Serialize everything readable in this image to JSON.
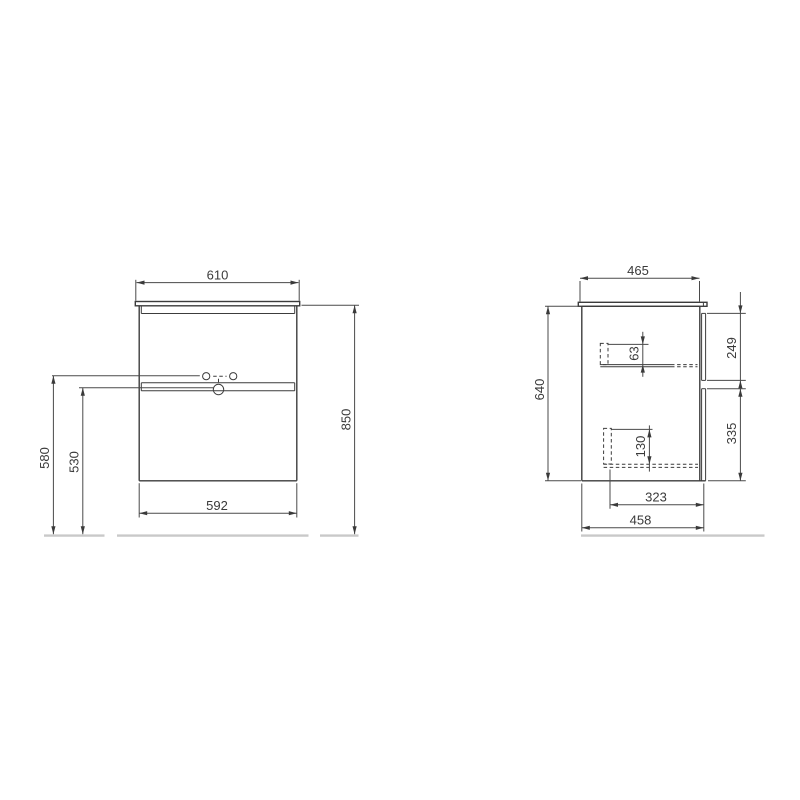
{
  "front_view": {
    "dim_top_width": "610",
    "dim_overall_height": "850",
    "dim_height_to_basin": "580",
    "dim_height_to_divider": "530",
    "dim_cabinet_width": "592"
  },
  "side_view": {
    "dim_top_depth": "465",
    "dim_body_height": "640",
    "dim_top_drawer_front_height": "249",
    "dim_bottom_drawer_front_height": "335",
    "dim_top_drawer_inner_height": "63",
    "dim_bottom_drawer_inner_height": "130",
    "dim_drawer_inner_depth": "323",
    "dim_body_depth": "458"
  },
  "colors": {
    "object_line": "#3c3c3c",
    "dimension_line": "#4a4a4a",
    "floor_line": "#c9c9c9",
    "background": "#ffffff"
  }
}
